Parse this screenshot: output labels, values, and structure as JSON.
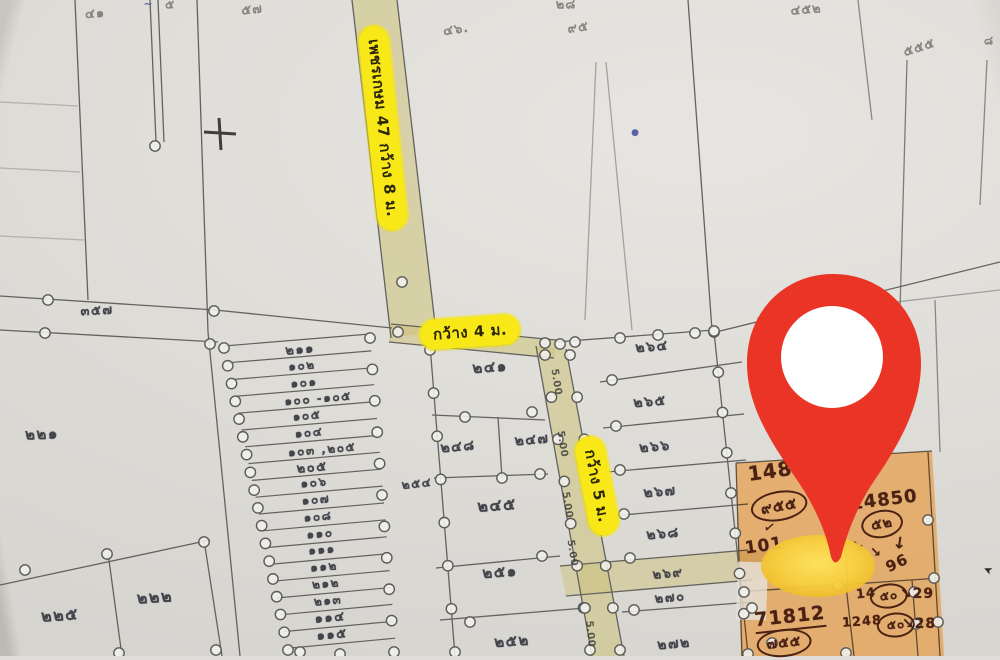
{
  "map": {
    "colors": {
      "paper": "#e0deda",
      "road_highlight": "#cfc480",
      "label_yellow": "#f8e818",
      "plot_highlight_orange": "#e88f28",
      "pin_red": "#ea3425",
      "pin_glow_yellow": "#f7d748",
      "line_gray": "#63625e",
      "ink_brown": "#4b2113"
    },
    "label_groups": {
      "road_labels": {
        "cls": "lbl-road",
        "role": "road-name-label",
        "items": [
          {
            "text": "เพชรเกษม 47 กว้าง 8 ม.",
            "x": 383,
            "y": 128,
            "rotate": 84,
            "size": 15
          },
          {
            "text": "กว้าง 4 ม.",
            "x": 470,
            "y": 332,
            "rotate": -4,
            "size": 15
          },
          {
            "text": "กว้าง 5 ม.",
            "x": 597,
            "y": 486,
            "rotate": 79,
            "size": 15
          }
        ]
      },
      "strip_numbers": {
        "cls": "lbl-strip",
        "role": "plot-number-label",
        "items": [
          {
            "text": "๒๑๑",
            "x": 300,
            "y": 349,
            "rotate": -5,
            "size": 13
          },
          {
            "text": "๑๐๒",
            "x": 302,
            "y": 366,
            "rotate": -5,
            "size": 12
          },
          {
            "text": "๑๐๑",
            "x": 304,
            "y": 383,
            "rotate": -5,
            "size": 12
          },
          {
            "text": "๑๐๐ -๑๐๕",
            "x": 318,
            "y": 399,
            "rotate": -5,
            "size": 12
          },
          {
            "text": "๑๐๕",
            "x": 307,
            "y": 416,
            "rotate": -5,
            "size": 12
          },
          {
            "text": "๑๐๔",
            "x": 309,
            "y": 433,
            "rotate": -5,
            "size": 12
          },
          {
            "text": "๑๐๓ ,๒๐๕",
            "x": 322,
            "y": 450,
            "rotate": -5,
            "size": 12
          },
          {
            "text": "๒๐๕",
            "x": 312,
            "y": 467,
            "rotate": -5,
            "size": 13
          },
          {
            "text": "๑๐๖",
            "x": 314,
            "y": 483,
            "rotate": -5,
            "size": 12
          },
          {
            "text": "๑๐๗",
            "x": 316,
            "y": 500,
            "rotate": -5,
            "size": 12
          },
          {
            "text": "๑๐๘",
            "x": 318,
            "y": 517,
            "rotate": -5,
            "size": 12
          },
          {
            "text": "๑๑๐",
            "x": 320,
            "y": 534,
            "rotate": -5,
            "size": 12
          },
          {
            "text": "๑๑๑",
            "x": 322,
            "y": 550,
            "rotate": -5,
            "size": 12
          },
          {
            "text": "๑๑๒",
            "x": 324,
            "y": 567,
            "rotate": -5,
            "size": 12
          },
          {
            "text": "๒๑๒",
            "x": 326,
            "y": 584,
            "rotate": -5,
            "size": 12
          },
          {
            "text": "๒๑๓",
            "x": 328,
            "y": 601,
            "rotate": -5,
            "size": 12
          },
          {
            "text": "๑๑๔",
            "x": 330,
            "y": 617,
            "rotate": -5,
            "size": 13
          },
          {
            "text": "๑๑๕",
            "x": 332,
            "y": 634,
            "rotate": -5,
            "size": 13
          }
        ]
      },
      "plot_numbers": {
        "cls": "lbl-plot",
        "role": "plot-number-label",
        "items": [
          {
            "text": "๓๕๗",
            "x": 97,
            "y": 310,
            "rotate": -3,
            "size": 13
          },
          {
            "text": "๒๒๑",
            "x": 42,
            "y": 434,
            "rotate": -2,
            "size": 15
          },
          {
            "text": "๒๒๕",
            "x": 60,
            "y": 616,
            "rotate": -4,
            "size": 16
          },
          {
            "text": "๒๒๒",
            "x": 155,
            "y": 598,
            "rotate": -4,
            "size": 16
          },
          {
            "text": "๒๔๑",
            "x": 490,
            "y": 367,
            "rotate": -4,
            "size": 15
          },
          {
            "text": "๒๔๘",
            "x": 458,
            "y": 447,
            "rotate": -5,
            "size": 14
          },
          {
            "text": "๒๔๗",
            "x": 532,
            "y": 440,
            "rotate": -5,
            "size": 14
          },
          {
            "text": "๒๔๕",
            "x": 497,
            "y": 506,
            "rotate": -4,
            "size": 16
          },
          {
            "text": "๒๕๑",
            "x": 500,
            "y": 572,
            "rotate": -4,
            "size": 15
          },
          {
            "text": "๒๕๒",
            "x": 512,
            "y": 641,
            "rotate": -4,
            "size": 15
          },
          {
            "text": "๒๕๔",
            "x": 417,
            "y": 484,
            "rotate": -6,
            "size": 12
          },
          {
            "text": "๒๖๔",
            "x": 652,
            "y": 347,
            "rotate": -5,
            "size": 14
          },
          {
            "text": "๒๖๕",
            "x": 650,
            "y": 402,
            "rotate": -5,
            "size": 14
          },
          {
            "text": "๒๖๖",
            "x": 655,
            "y": 447,
            "rotate": -5,
            "size": 14
          },
          {
            "text": "๒๖๗",
            "x": 660,
            "y": 492,
            "rotate": -5,
            "size": 14
          },
          {
            "text": "๒๖๘",
            "x": 663,
            "y": 534,
            "rotate": -5,
            "size": 14
          },
          {
            "text": "๒๖๙",
            "x": 668,
            "y": 573,
            "rotate": -5,
            "size": 13
          },
          {
            "text": "๒๗๐",
            "x": 670,
            "y": 597,
            "rotate": -5,
            "size": 13
          },
          {
            "text": "๒๗๒",
            "x": 674,
            "y": 644,
            "rotate": -5,
            "size": 14
          }
        ]
      },
      "pencil_notes": {
        "cls": "lbl-pencil",
        "role": "pencil-annotation",
        "items": [
          {
            "text": "๔๑",
            "x": 95,
            "y": 13,
            "rotate": -4,
            "size": 13
          },
          {
            "text": "๕",
            "x": 170,
            "y": 5,
            "rotate": 0,
            "size": 12
          },
          {
            "text": "๕๗",
            "x": 252,
            "y": 9,
            "rotate": -6,
            "size": 13
          },
          {
            "text": "๔๖.",
            "x": 456,
            "y": 29,
            "rotate": -8,
            "size": 13
          },
          {
            "text": "๒๘",
            "x": 566,
            "y": 4,
            "rotate": 0,
            "size": 13
          },
          {
            "text": "๙๕",
            "x": 578,
            "y": 27,
            "rotate": -8,
            "size": 13
          },
          {
            "text": "๔๕๒",
            "x": 806,
            "y": 9,
            "rotate": -5,
            "size": 13
          },
          {
            "text": "๕๕๕",
            "x": 919,
            "y": 47,
            "rotate": -18,
            "size": 13
          },
          {
            "text": "๘",
            "x": 989,
            "y": 41,
            "rotate": 0,
            "size": 12
          }
        ]
      },
      "road_width_marks": {
        "cls": "lbl-mark",
        "role": "road-width-mark",
        "items": [
          {
            "text": "5.00",
            "x": 556,
            "y": 382,
            "rotate": 81,
            "size": 10
          },
          {
            "text": "5.00",
            "x": 562,
            "y": 444,
            "rotate": 81,
            "size": 10
          },
          {
            "text": "5.00",
            "x": 567,
            "y": 505,
            "rotate": 81,
            "size": 10
          },
          {
            "text": "5.00",
            "x": 572,
            "y": 553,
            "rotate": 81,
            "size": 10
          },
          {
            "text": "5.00",
            "x": 590,
            "y": 634,
            "rotate": 84,
            "size": 10
          }
        ]
      },
      "orange_notes": {
        "cls": "lbl-ink",
        "role": "handwritten-note",
        "items": [
          {
            "text": "148",
            "x": 770,
            "y": 471,
            "rotate": -8,
            "size": 20
          },
          {
            "text": "๙๕๕",
            "x": 779,
            "y": 506,
            "rotate": -10,
            "size": 15,
            "circled": true
          },
          {
            "text": "✓",
            "x": 770,
            "y": 528,
            "rotate": 10,
            "size": 14
          },
          {
            "text": "101",
            "x": 764,
            "y": 546,
            "rotate": -8,
            "size": 17
          },
          {
            "text": "14850",
            "x": 884,
            "y": 500,
            "rotate": -7,
            "size": 18
          },
          {
            "text": "๕๒",
            "x": 882,
            "y": 524,
            "rotate": -10,
            "size": 14,
            "circled": true
          },
          {
            "text": "↓",
            "x": 900,
            "y": 543,
            "rotate": 8,
            "size": 16
          },
          {
            "text": "↘",
            "x": 858,
            "y": 546,
            "rotate": 0,
            "size": 15
          },
          {
            "text": "↘",
            "x": 876,
            "y": 553,
            "rotate": 0,
            "size": 13
          },
          {
            "text": "96",
            "x": 897,
            "y": 563,
            "rotate": -25,
            "size": 15
          },
          {
            "text": "14",
            "x": 866,
            "y": 594,
            "rotate": -6,
            "size": 13
          },
          {
            "text": "๕๐",
            "x": 889,
            "y": 596,
            "rotate": -6,
            "size": 12,
            "circled": true
          },
          {
            "text": "↘29",
            "x": 917,
            "y": 594,
            "rotate": 0,
            "size": 14
          },
          {
            "text": "1248",
            "x": 862,
            "y": 622,
            "rotate": -4,
            "size": 13
          },
          {
            "text": "๕๐",
            "x": 896,
            "y": 625,
            "rotate": -4,
            "size": 12,
            "circled": true
          },
          {
            "text": "↘28",
            "x": 919,
            "y": 624,
            "rotate": 0,
            "size": 14
          },
          {
            "text": "71812",
            "x": 790,
            "y": 618,
            "rotate": -6,
            "size": 19,
            "underline": true
          },
          {
            "text": "๗๕๕",
            "x": 784,
            "y": 643,
            "rotate": -6,
            "size": 14,
            "circled": true
          }
        ]
      },
      "ink_marks": {
        "cls": "lbl-blue",
        "role": "ink-mark",
        "items": [
          {
            "text": "●",
            "x": 635,
            "y": 133,
            "rotate": 0,
            "size": 9
          },
          {
            "text": "~",
            "x": 148,
            "y": 4,
            "rotate": 0,
            "size": 11
          },
          {
            "text": "➤",
            "x": 988,
            "y": 570,
            "rotate": 205,
            "size": 11,
            "dark": true
          }
        ]
      }
    }
  }
}
